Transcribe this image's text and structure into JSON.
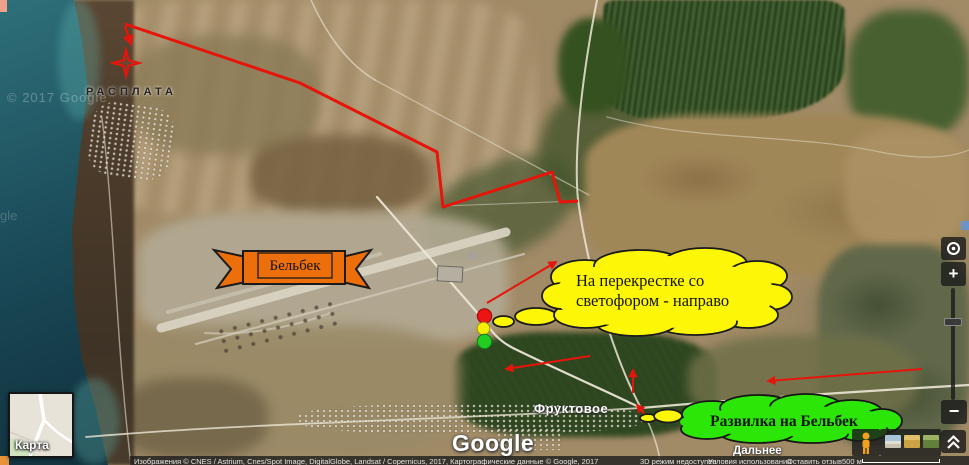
{
  "map": {
    "labels": {
      "rasplata": "РАСПЛАТА",
      "fruktovoe": "Фруктовое",
      "dalneye": "Дальнее"
    },
    "watermark": "© 2017 Google",
    "watermark_partial": "gle"
  },
  "annotations": {
    "banner_label": "Бельбек",
    "traffic_note_line1": "На перекрестке со",
    "traffic_note_line2": "светофором - направо",
    "fork_note": "Развилка на Бельбек"
  },
  "controls": {
    "minimap_label": "Карта",
    "zoom_in_label": "+",
    "zoom_out_label": "−"
  },
  "branding": {
    "logo": "Google"
  },
  "footer": {
    "attribution": "Изображения © CNES / Astrium, Cnes/Spot Image, DigitalGlobe, Landsat / Copernicus, 2017, Картографические данные © Google, 2017",
    "mode_3d_notice": "3D режим недоступен",
    "terms_link": "Условия использования",
    "feedback_link": "Оставить отзыв",
    "scale_text": "500 м"
  },
  "colors": {
    "route_red": "#e6150b",
    "banner_orange": "#ec6f0c",
    "note_yellow": "#fdf606",
    "note_green": "#2be607",
    "traffic_red": "#ee1414",
    "traffic_yellow": "#f8ef00",
    "traffic_green": "#22cc22",
    "sea_teal": "#1d4f5c"
  }
}
